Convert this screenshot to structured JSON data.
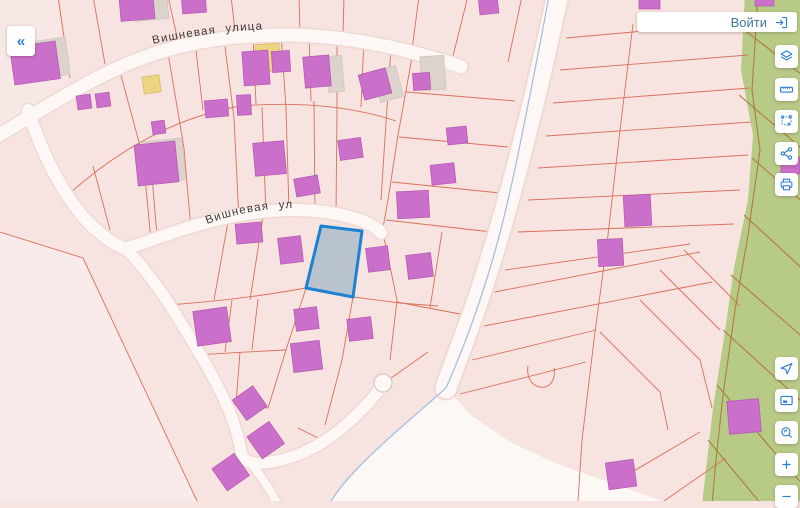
{
  "header": {
    "back_label": "«",
    "login_label": "Войти",
    "login_icon": "login-arrow-icon"
  },
  "map": {
    "street_labels": [
      {
        "text": "Вишневая улица"
      },
      {
        "text": "Вишневая улица"
      }
    ],
    "selected_parcel": {
      "fill": "#b9c3ce",
      "stroke": "#1e82d2"
    },
    "colors": {
      "base": "#f7e3e0",
      "base_light": "#f9ebe9",
      "parcel_line": "#d9705a",
      "road_fill": "#fdf8f6",
      "road_casing": "#eed9d3",
      "building": "#cb70ca",
      "building_yellow": "#ead584",
      "building_shadow": "#ddd3cd",
      "green_zone": "#b7cb87",
      "green_line": "#ad7c3e",
      "water_line": "#a9bedd",
      "accent": "#2b7cd2"
    }
  },
  "toolbar": {
    "top_group": [
      {
        "name": "layers-icon"
      },
      {
        "name": "ruler-icon"
      },
      {
        "name": "select-area-icon"
      },
      {
        "name": "share-icon"
      },
      {
        "name": "print-icon"
      }
    ],
    "bottom_group": [
      {
        "name": "locate-icon"
      },
      {
        "name": "minimap-icon"
      },
      {
        "name": "search-area-icon"
      },
      {
        "name": "zoom-in-icon"
      },
      {
        "name": "zoom-out-icon"
      }
    ]
  }
}
